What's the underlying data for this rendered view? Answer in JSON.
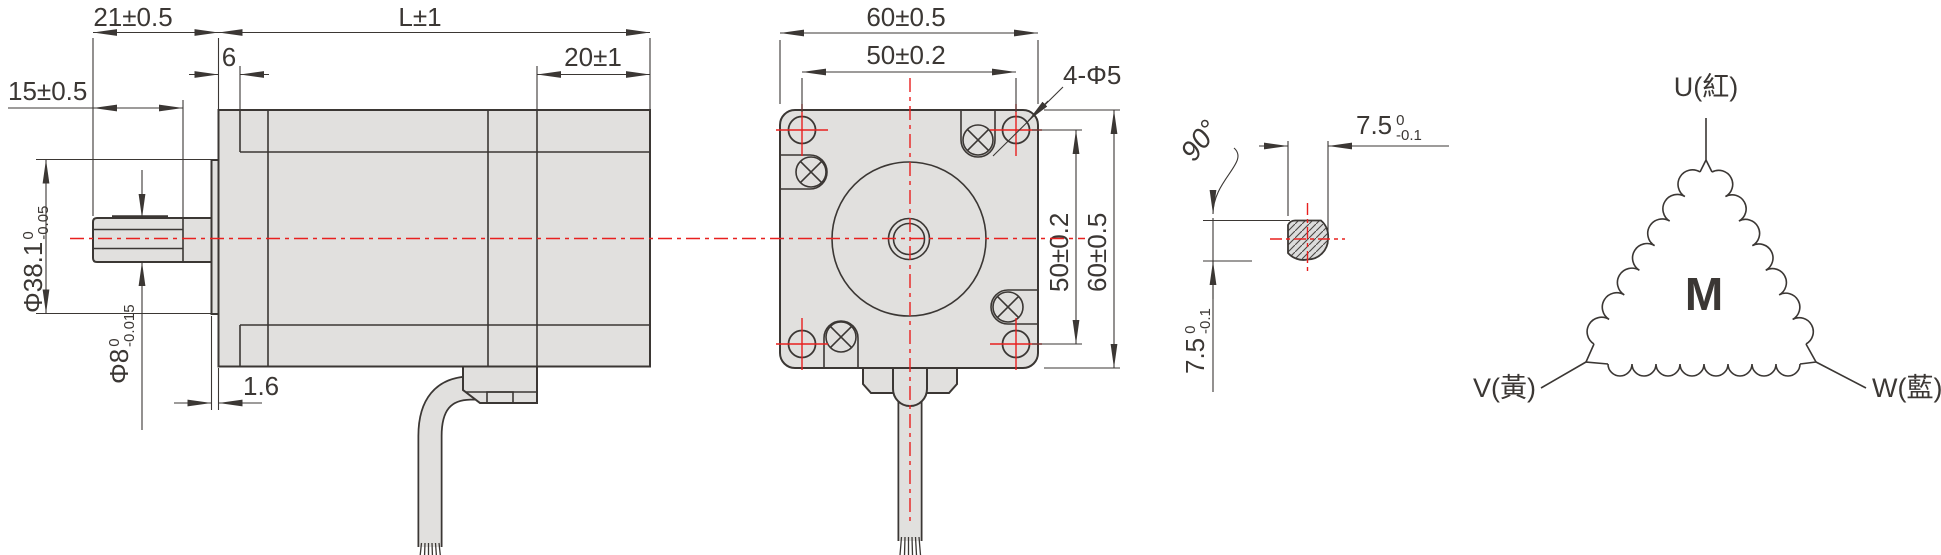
{
  "drawing": {
    "side_view": {
      "dim_shaft_tip_to_flange": "21±0.5",
      "dim_body_length": "L±1",
      "dim_pilot_step": "6",
      "dim_shaft_flat_length": "15±0.5",
      "dim_rear_section": "20±1",
      "dim_pilot_boss_dia": {
        "main": "Φ38.1",
        "tol_upper": "0",
        "tol_lower": "-0.05"
      },
      "dim_shaft_dia": {
        "main": "Φ8",
        "tol_upper": "0",
        "tol_lower": "-0.015"
      },
      "dim_boss_protrusion": "1.6"
    },
    "front_view": {
      "dim_width": "60±0.5",
      "dim_hole_spacing_h": "50±0.2",
      "dim_hole_spacing_v": "50±0.2",
      "dim_height": "60±0.5",
      "mounting_holes_label": "4-Φ5"
    },
    "shaft_section": {
      "flat_angle": "90°",
      "dim_flat_width": {
        "main": "7.5",
        "tol_upper": "0",
        "tol_lower": "-0.1"
      },
      "dim_flat_height": {
        "main": "7.5",
        "tol_upper": "0",
        "tol_lower": "-0.1"
      }
    },
    "winding_diagram": {
      "motor_symbol": "M",
      "phase_u": "U(紅)",
      "phase_v": "V(黃)",
      "phase_w": "W(藍)"
    },
    "colors": {
      "line": "#3b3734",
      "fill": "#e1e0de",
      "centerline_red": "#e8201f"
    }
  }
}
